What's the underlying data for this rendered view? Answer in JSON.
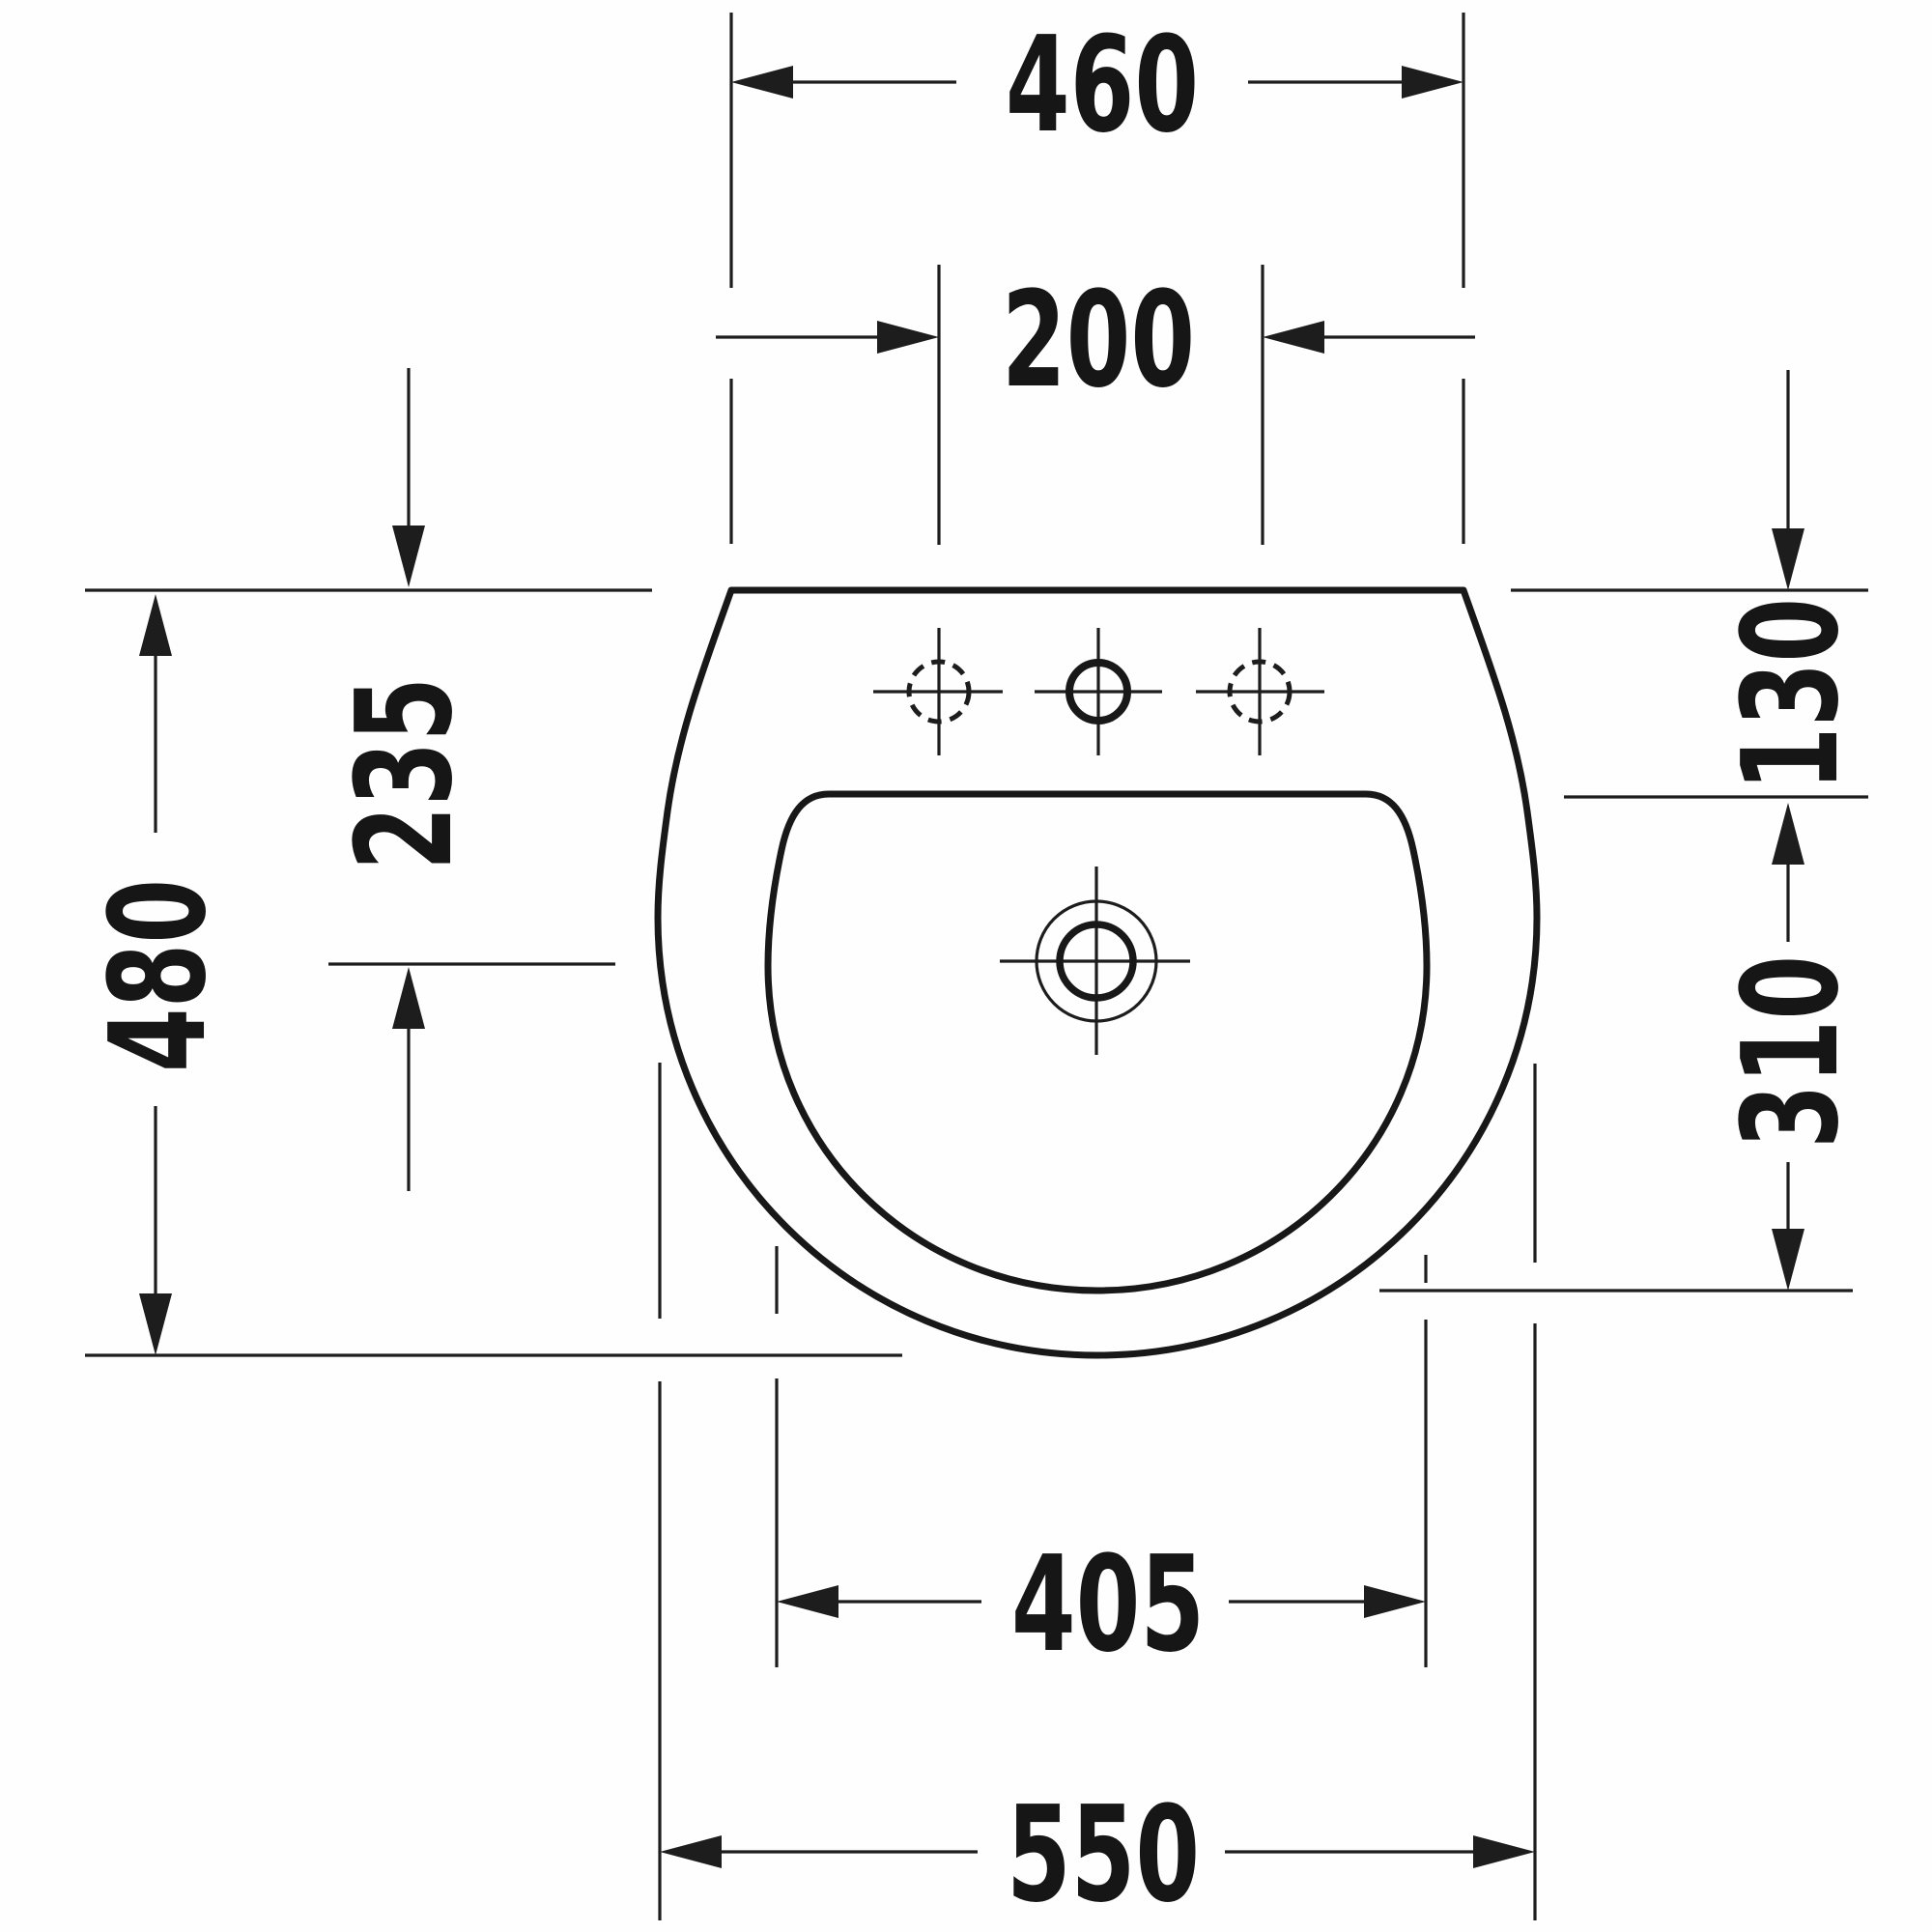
{
  "drawing": {
    "type": "technical-dimension-diagram",
    "subject": "washbasin top view",
    "background_color": "#fefefe",
    "line_color": "#1d1d1d",
    "labels": {
      "top_width": "460",
      "hole_spacing": "200",
      "overall_depth": "480",
      "drain_center_offset": "235",
      "rim_to_basin": "130",
      "basin_depth": "310",
      "inner_bottom_width": "405",
      "overall_width": "550"
    }
  }
}
